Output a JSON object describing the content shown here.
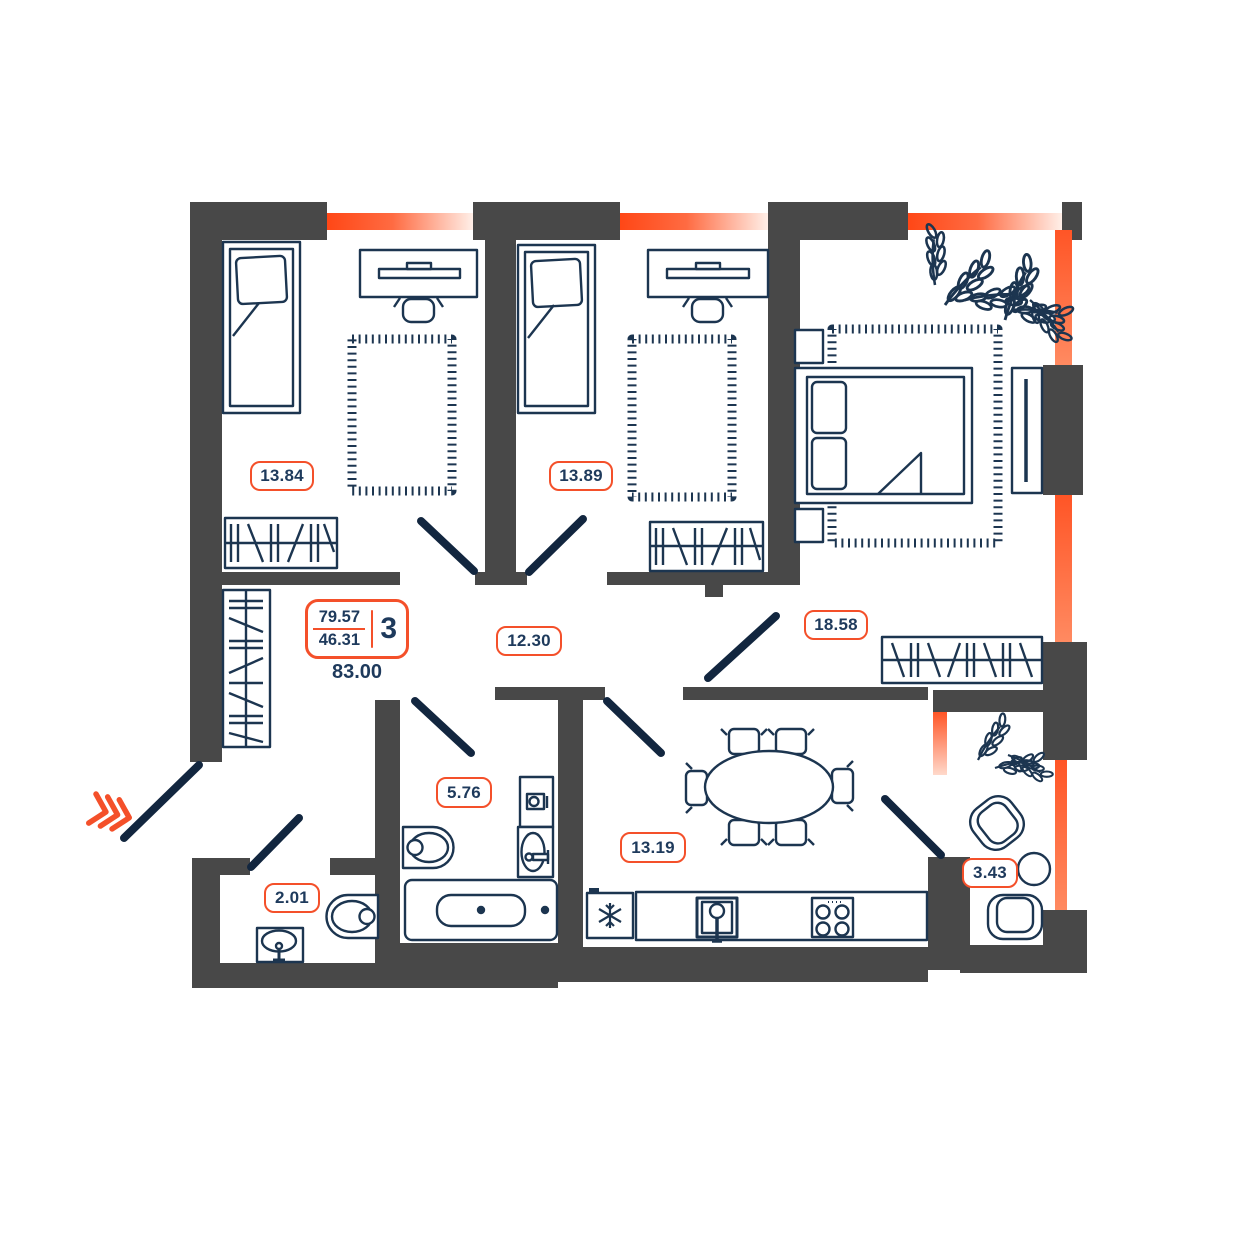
{
  "floor_plan": {
    "type": "apartment-floor-plan",
    "rooms": [
      {
        "name": "bedroom-1",
        "area_label": "13.84"
      },
      {
        "name": "bedroom-2",
        "area_label": "13.89"
      },
      {
        "name": "living-room",
        "area_label": "18.58"
      },
      {
        "name": "hallway",
        "area_label": "12.30"
      },
      {
        "name": "bathroom",
        "area_label": "5.76"
      },
      {
        "name": "wc",
        "area_label": "2.01"
      },
      {
        "name": "kitchen",
        "area_label": "13.19"
      },
      {
        "name": "balcony",
        "area_label": "3.43"
      }
    ],
    "summary": {
      "area_main": "79.57",
      "area_living": "46.31",
      "rooms_count": "3",
      "area_total": "83.00"
    },
    "colors": {
      "accent_orange": "#F4502A",
      "window_orange": "#FF4F1F",
      "wall_gray": "#484848",
      "line_navy": "#1C3550"
    },
    "icons": [
      "entrance-chevrons-icon",
      "snowflake-icon",
      "plant-icon"
    ]
  }
}
